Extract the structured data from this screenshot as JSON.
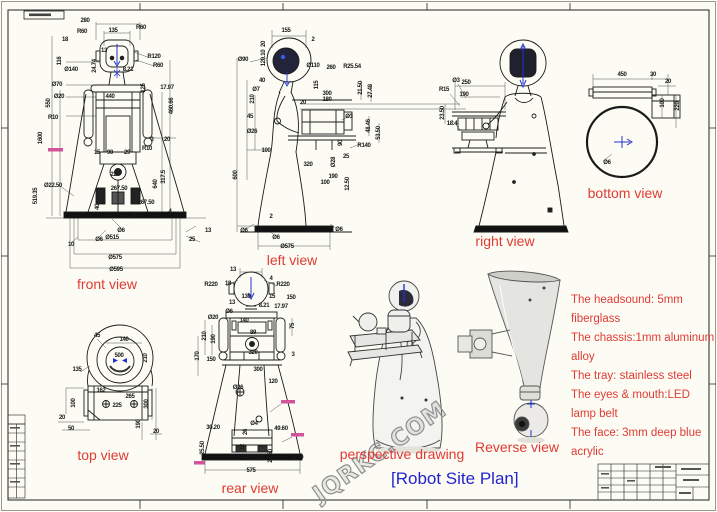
{
  "sheet": {
    "background": "#fcfcf4",
    "line_color": "#1b1b1b",
    "label_color": "#e03a34",
    "title_color": "#2323cc",
    "accent_blue": "#2233cc",
    "pink_note_color": "#d0559a",
    "watermark_text": "JQRKC.COM",
    "title": "[Robot Site Plan]"
  },
  "notes": {
    "lines": [
      "The headsound: 5mm",
      "fiberglass",
      "The chassis:1mm aluminum",
      "alloy",
      "The tray: stainless steel",
      "The eyes & mouth:LED",
      "lamp belt",
      "The face: 3mm deep blue",
      "acrylic"
    ]
  },
  "views": [
    {
      "id": "front-view",
      "label": "front view",
      "label_x": 107,
      "label_y": 284,
      "dims": [
        {
          "t": "280",
          "x": 85,
          "y": 21
        },
        {
          "t": "135",
          "x": 113,
          "y": 31
        },
        {
          "t": "18",
          "x": 65,
          "y": 40
        },
        {
          "t": "R60",
          "x": 82,
          "y": 32
        },
        {
          "t": "R60",
          "x": 141,
          "y": 28
        },
        {
          "t": "R120",
          "x": 154,
          "y": 57
        },
        {
          "t": "R60",
          "x": 158,
          "y": 66
        },
        {
          "t": "13",
          "x": 104,
          "y": 51
        },
        {
          "t": "116",
          "x": 60,
          "y": 61,
          "r": 1
        },
        {
          "t": "Ø140",
          "x": 71,
          "y": 70
        },
        {
          "t": "24.74",
          "x": 95,
          "y": 66,
          "r": 1
        },
        {
          "t": "8.21",
          "x": 128,
          "y": 70
        },
        {
          "t": "17.97",
          "x": 167,
          "y": 88
        },
        {
          "t": "125",
          "x": 144,
          "y": 88,
          "r": 1
        },
        {
          "t": "Ø70",
          "x": 57,
          "y": 85
        },
        {
          "t": "Ø20",
          "x": 59,
          "y": 97
        },
        {
          "t": "550",
          "x": 49,
          "y": 103,
          "r": 1
        },
        {
          "t": "R10",
          "x": 53,
          "y": 118
        },
        {
          "t": "440",
          "x": 110,
          "y": 97
        },
        {
          "t": "460.66",
          "x": 172,
          "y": 106,
          "r": 1
        },
        {
          "t": "1600",
          "x": 41,
          "y": 138,
          "r": 1
        },
        {
          "t": "519.35",
          "x": 36,
          "y": 196,
          "r": 1
        },
        {
          "t": "Ø22.50",
          "x": 53,
          "y": 186
        },
        {
          "t": "3",
          "x": 152,
          "y": 140
        },
        {
          "t": "20",
          "x": 167,
          "y": 140
        },
        {
          "t": "15",
          "x": 97,
          "y": 153
        },
        {
          "t": "90",
          "x": 110,
          "y": 153
        },
        {
          "t": "29",
          "x": 127,
          "y": 153
        },
        {
          "t": "R10",
          "x": 147,
          "y": 149
        },
        {
          "t": "220",
          "x": 115,
          "y": 175
        },
        {
          "t": "317.5",
          "x": 164,
          "y": 177,
          "r": 1
        },
        {
          "t": "640",
          "x": 156,
          "y": 184,
          "r": 1
        },
        {
          "t": "267.50",
          "x": 119,
          "y": 189
        },
        {
          "t": "40",
          "x": 98,
          "y": 207,
          "r": 1
        },
        {
          "t": "267.50",
          "x": 146,
          "y": 203
        },
        {
          "t": "20",
          "x": 135,
          "y": 216
        },
        {
          "t": "4",
          "x": 170,
          "y": 212
        },
        {
          "t": "13",
          "x": 208,
          "y": 231
        },
        {
          "t": "Ø6",
          "x": 121,
          "y": 231
        },
        {
          "t": "Ø6",
          "x": 99,
          "y": 240
        },
        {
          "t": "Ø515",
          "x": 112,
          "y": 238
        },
        {
          "t": "Ø575",
          "x": 115,
          "y": 258
        },
        {
          "t": "Ø595",
          "x": 116,
          "y": 270
        },
        {
          "t": "10",
          "x": 71,
          "y": 245
        },
        {
          "t": "25",
          "x": 192,
          "y": 240
        }
      ]
    },
    {
      "id": "left-view",
      "label": "left view",
      "label_x": 292,
      "label_y": 260,
      "dims": [
        {
          "t": "155",
          "x": 286,
          "y": 31
        },
        {
          "t": "2",
          "x": 313,
          "y": 40
        },
        {
          "t": "Ø90",
          "x": 243,
          "y": 60
        },
        {
          "t": "20",
          "x": 264,
          "y": 44,
          "r": 1
        },
        {
          "t": "120.10",
          "x": 264,
          "y": 58,
          "r": 1
        },
        {
          "t": "Ø110",
          "x": 313,
          "y": 66
        },
        {
          "t": "260",
          "x": 331,
          "y": 68
        },
        {
          "t": "R25.54",
          "x": 352,
          "y": 67
        },
        {
          "t": "21.50",
          "x": 361,
          "y": 88,
          "r": 1
        },
        {
          "t": "27.48",
          "x": 371,
          "y": 91,
          "r": 1
        },
        {
          "t": "40",
          "x": 262,
          "y": 81
        },
        {
          "t": "Ø7",
          "x": 256,
          "y": 90
        },
        {
          "t": "210",
          "x": 253,
          "y": 99,
          "r": 1
        },
        {
          "t": "115",
          "x": 317,
          "y": 85,
          "r": 1
        },
        {
          "t": "300",
          "x": 327,
          "y": 94
        },
        {
          "t": "180",
          "x": 327,
          "y": 100
        },
        {
          "t": "20",
          "x": 303,
          "y": 103
        },
        {
          "t": "Ø3",
          "x": 349,
          "y": 117
        },
        {
          "t": "45",
          "x": 250,
          "y": 117
        },
        {
          "t": "48.46",
          "x": 369,
          "y": 126,
          "r": 1
        },
        {
          "t": "53.50",
          "x": 379,
          "y": 133,
          "r": 1
        },
        {
          "t": "Ø26",
          "x": 252,
          "y": 132
        },
        {
          "t": "90",
          "x": 341,
          "y": 143,
          "r": 1
        },
        {
          "t": "R140",
          "x": 364,
          "y": 146
        },
        {
          "t": "100",
          "x": 266,
          "y": 151
        },
        {
          "t": "320",
          "x": 308,
          "y": 165
        },
        {
          "t": "25",
          "x": 346,
          "y": 157
        },
        {
          "t": "Ø28",
          "x": 334,
          "y": 162,
          "r": 1
        },
        {
          "t": "190",
          "x": 333,
          "y": 177
        },
        {
          "t": "100",
          "x": 325,
          "y": 183
        },
        {
          "t": "12.50",
          "x": 348,
          "y": 184,
          "r": 1
        },
        {
          "t": "600",
          "x": 236,
          "y": 175,
          "r": 1
        },
        {
          "t": "2",
          "x": 271,
          "y": 217
        },
        {
          "t": "Ø6",
          "x": 244,
          "y": 231
        },
        {
          "t": "Ø6",
          "x": 276,
          "y": 238
        },
        {
          "t": "Ø6",
          "x": 339,
          "y": 230
        },
        {
          "t": "Ø575",
          "x": 287,
          "y": 247
        }
      ]
    },
    {
      "id": "right-view",
      "label": "right view",
      "label_x": 505,
      "label_y": 241,
      "dims": [
        {
          "t": "250",
          "x": 466,
          "y": 83
        },
        {
          "t": "190",
          "x": 464,
          "y": 95
        },
        {
          "t": "R15",
          "x": 444,
          "y": 90
        },
        {
          "t": "Ø3",
          "x": 456,
          "y": 81
        },
        {
          "t": "23.50",
          "x": 443,
          "y": 113,
          "r": 1
        },
        {
          "t": "18.4",
          "x": 452,
          "y": 124
        }
      ]
    },
    {
      "id": "bottom-view",
      "label": "bottom view",
      "label_x": 625,
      "label_y": 193,
      "dims": [
        {
          "t": "450",
          "x": 622,
          "y": 75
        },
        {
          "t": "30",
          "x": 653,
          "y": 75
        },
        {
          "t": "20",
          "x": 668,
          "y": 82
        },
        {
          "t": "100",
          "x": 663,
          "y": 103,
          "r": 1
        },
        {
          "t": "220",
          "x": 678,
          "y": 106,
          "r": 1
        },
        {
          "t": "Ø6",
          "x": 607,
          "y": 163
        }
      ]
    },
    {
      "id": "top-view",
      "label": "top view",
      "label_x": 103,
      "label_y": 455,
      "dims": [
        {
          "t": "45",
          "x": 97,
          "y": 336
        },
        {
          "t": "140",
          "x": 124,
          "y": 340
        },
        {
          "t": "500",
          "x": 119,
          "y": 356
        },
        {
          "t": "210",
          "x": 146,
          "y": 358,
          "r": 1
        },
        {
          "t": "135",
          "x": 77,
          "y": 370
        },
        {
          "t": "162",
          "x": 101,
          "y": 391
        },
        {
          "t": "265",
          "x": 130,
          "y": 397
        },
        {
          "t": "225",
          "x": 117,
          "y": 406
        },
        {
          "t": "100",
          "x": 74,
          "y": 403,
          "r": 1
        },
        {
          "t": "20",
          "x": 62,
          "y": 418
        },
        {
          "t": "50",
          "x": 71,
          "y": 429
        },
        {
          "t": "300",
          "x": 147,
          "y": 404,
          "r": 1
        },
        {
          "t": "190",
          "x": 139,
          "y": 424,
          "r": 1
        },
        {
          "t": "20",
          "x": 156,
          "y": 432
        }
      ]
    },
    {
      "id": "rear-view",
      "label": "rear view",
      "label_x": 250,
      "label_y": 488,
      "dims": [
        {
          "t": "13",
          "x": 233,
          "y": 270
        },
        {
          "t": "R220",
          "x": 211,
          "y": 285
        },
        {
          "t": "18",
          "x": 228,
          "y": 284
        },
        {
          "t": "4",
          "x": 271,
          "y": 279
        },
        {
          "t": "R220",
          "x": 283,
          "y": 285
        },
        {
          "t": "130",
          "x": 246,
          "y": 297
        },
        {
          "t": "15",
          "x": 272,
          "y": 297
        },
        {
          "t": "150",
          "x": 291,
          "y": 298
        },
        {
          "t": "13",
          "x": 232,
          "y": 303
        },
        {
          "t": "Ø6",
          "x": 229,
          "y": 312
        },
        {
          "t": "8.21",
          "x": 264,
          "y": 306
        },
        {
          "t": "17.97",
          "x": 281,
          "y": 307
        },
        {
          "t": "Ø20",
          "x": 213,
          "y": 318
        },
        {
          "t": "140",
          "x": 244,
          "y": 321
        },
        {
          "t": "89",
          "x": 253,
          "y": 333
        },
        {
          "t": "75",
          "x": 293,
          "y": 326,
          "r": 1
        },
        {
          "t": "210",
          "x": 205,
          "y": 336,
          "r": 1
        },
        {
          "t": "190",
          "x": 214,
          "y": 339,
          "r": 1
        },
        {
          "t": "170",
          "x": 198,
          "y": 356,
          "r": 1
        },
        {
          "t": "320",
          "x": 253,
          "y": 353
        },
        {
          "t": "150",
          "x": 211,
          "y": 360
        },
        {
          "t": "3",
          "x": 293,
          "y": 355
        },
        {
          "t": "300",
          "x": 258,
          "y": 370
        },
        {
          "t": "120",
          "x": 273,
          "y": 382
        },
        {
          "t": "Ø26",
          "x": 238,
          "y": 388
        },
        {
          "t": "30.20",
          "x": 213,
          "y": 428
        },
        {
          "t": "Ø4",
          "x": 254,
          "y": 424
        },
        {
          "t": "49.60",
          "x": 281,
          "y": 429
        },
        {
          "t": "26",
          "x": 246,
          "y": 432,
          "r": 1
        },
        {
          "t": "25.50",
          "x": 203,
          "y": 448,
          "r": 1
        },
        {
          "t": "12",
          "x": 243,
          "y": 447,
          "r": 1
        },
        {
          "t": "16",
          "x": 245,
          "y": 457
        },
        {
          "t": "22.50",
          "x": 271,
          "y": 456,
          "r": 1
        },
        {
          "t": "50",
          "x": 261,
          "y": 458
        },
        {
          "t": "8.00",
          "x": 298,
          "y": 458
        },
        {
          "t": "575",
          "x": 251,
          "y": 471
        }
      ]
    },
    {
      "id": "perspective-drawing",
      "label": "perspective drawing",
      "label_x": 402,
      "label_y": 454,
      "dims": []
    },
    {
      "id": "reverse-view",
      "label": "Reverse view",
      "label_x": 517,
      "label_y": 447,
      "dims": []
    }
  ]
}
